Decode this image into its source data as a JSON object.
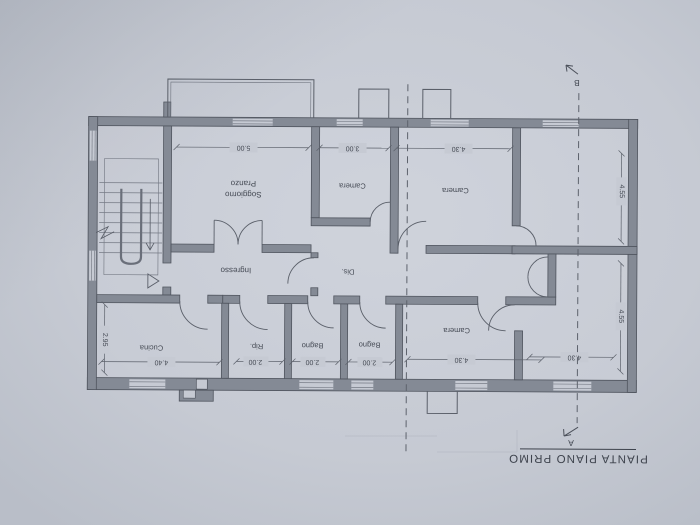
{
  "drawing": {
    "title": "PIANTA PIANO PRIMO",
    "sections": {
      "top_label": "B",
      "bottom_label": "A"
    },
    "rooms": {
      "pranzo_line": "Pranzo",
      "soggiorno_line": "Soggiorno",
      "camera_small": "Camera",
      "camera_top_right": "Camera",
      "ingresso": "Ingresso",
      "dis": "Dis.",
      "cucina": "Cucina",
      "rip": "Rip.",
      "bagno_left": "Bagno",
      "bagno_right": "Bagno",
      "camera_bottom": "Camera"
    },
    "dimensions": {
      "soggiorno_width": "5.00",
      "camera_small_width": "3.00",
      "camera_top_right_width": "4.30",
      "right_top_height": "4.55",
      "right_bottom_height": "4.55",
      "right_bottom_width": "4.30",
      "camera_bottom_width": "4.30",
      "cucina_width": "4.40",
      "cucina_height": "2.95",
      "rip_width": "2.00",
      "bagno_left_width": "2.00",
      "bagno_right_width": "2.00"
    },
    "colors": {
      "paper": "#c6cad3",
      "wall_fill": "#848a95",
      "line": "#565b65",
      "text": "#454a54"
    }
  }
}
